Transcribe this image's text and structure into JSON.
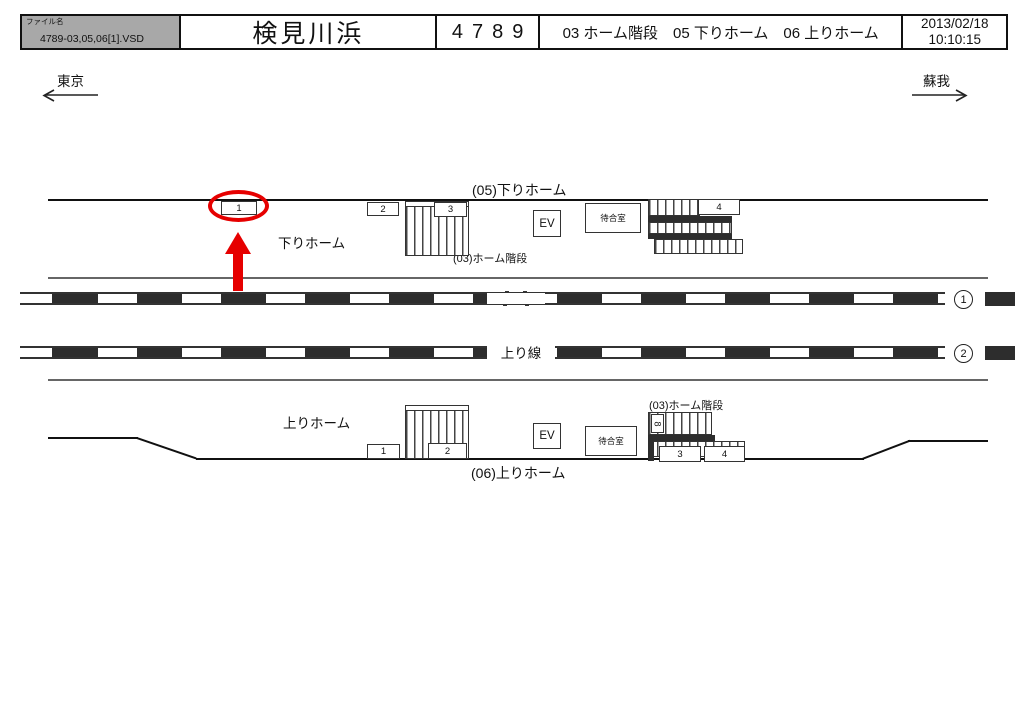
{
  "header": {
    "file_label": "ファイル名",
    "file_name": "4789-03,05,06[1].VSD",
    "station_name": "検見川浜",
    "number": "4789",
    "sections": "03 ホーム階段　05 下りホーム　06 上りホーム",
    "date": "2013/02/18",
    "time": "10:10:15"
  },
  "directions": {
    "left_label": "東京",
    "right_label": "蘇我"
  },
  "down_platform": {
    "title": "(05)下りホーム",
    "platform_label": "下りホーム",
    "stairs_label": "(03)ホーム階段",
    "elevator_label": "EV",
    "waiting_room_label": "待合室",
    "sign_boxes": [
      "1",
      "2",
      "3",
      "4"
    ]
  },
  "tracks": {
    "track1_number": "1",
    "track2_number": "2",
    "track2_label": "上り線"
  },
  "up_platform": {
    "title": "(06)上りホーム",
    "platform_label": "上りホーム",
    "stairs_label": "(03)ホーム階段",
    "elevator_label": "EV",
    "waiting_room_label": "待合室",
    "sign_boxes": [
      "1",
      "2",
      "3",
      "4"
    ],
    "stair_sign": "8"
  },
  "colors": {
    "highlight_red": "#e60000",
    "line_black": "#111111",
    "header_gray": "#a8a8a8"
  }
}
